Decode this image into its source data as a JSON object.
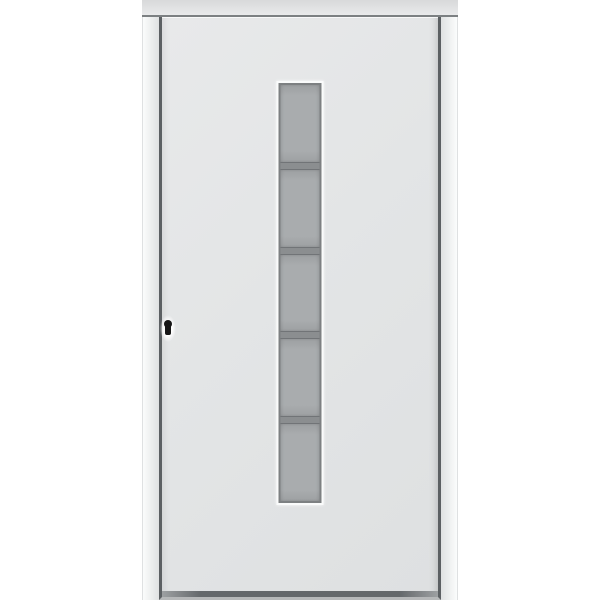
{
  "scene": {
    "description": "Product image of a white entry door in a white frame with a centered vertical strip of five frosted glass panes and a black keyhole on the left side",
    "text_on_screen": ""
  },
  "glazing": {
    "pane_count": 5,
    "divider_count": 4
  },
  "hardware": {
    "keyhole_present": true,
    "handle_present": false
  },
  "colors": {
    "page_bg": "#ffffff",
    "head_top": "#d8d9da",
    "head_bottom": "#e9eaeb",
    "head_shadow": "#7c8082",
    "jamb_light": "#fbfcfc",
    "jamb_mid": "#eceeee",
    "jamb_dark": "#dfe1e2",
    "gap_dark": "#5c6063",
    "leaf_light": "#e8e9ea",
    "leaf_mid": "#e3e5e6",
    "leaf_dark": "#dee0e1",
    "bottom_bar": "#64686b",
    "bottom_bar_end": "#9da0a2",
    "threshold": "#b6b8b9",
    "surround": "#fafbfb",
    "outline": "#7d8082",
    "glass": "#a9acae",
    "glass_edge": "#9da0a2",
    "divider": "#8b8e90",
    "divider_line": "#717477",
    "keyhole": "#161616",
    "halo": "#fdfdfd"
  }
}
